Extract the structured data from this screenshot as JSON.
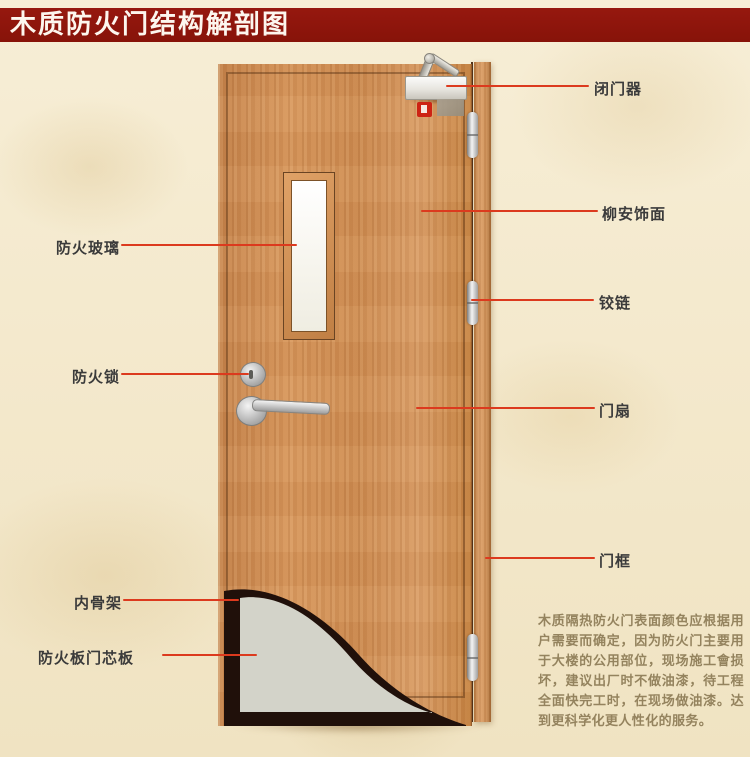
{
  "title": "木质防火门结构解剖图",
  "callouts": {
    "left": [
      {
        "id": "fireproof-glass",
        "label": "防火玻璃"
      },
      {
        "id": "fire-lock",
        "label": "防火锁"
      },
      {
        "id": "inner-skeleton",
        "label": "内骨架"
      },
      {
        "id": "fire-board-core",
        "label": "防火板门芯板"
      }
    ],
    "right": [
      {
        "id": "door-closer",
        "label": "闭门器"
      },
      {
        "id": "lauan-veneer",
        "label": "柳安饰面"
      },
      {
        "id": "hinge",
        "label": "铰链"
      },
      {
        "id": "door-leaf",
        "label": "门扇"
      },
      {
        "id": "door-frame",
        "label": "门框"
      }
    ]
  },
  "description": "木质隔热防火门表面颜色应根据用户需要而确定，因为防火门主要用于大楼的公用部位，现场施工會损坏，建议出厂时不做油漆，待工程全面快完工时，在现场做油漆。达到更科学化更人性化的服务。",
  "colors": {
    "banner": "#8e1510",
    "pointer": "#dc3a1e",
    "wood": "#cf8b52",
    "skeleton": "#20100a",
    "core_board": "#d3d3c9"
  }
}
